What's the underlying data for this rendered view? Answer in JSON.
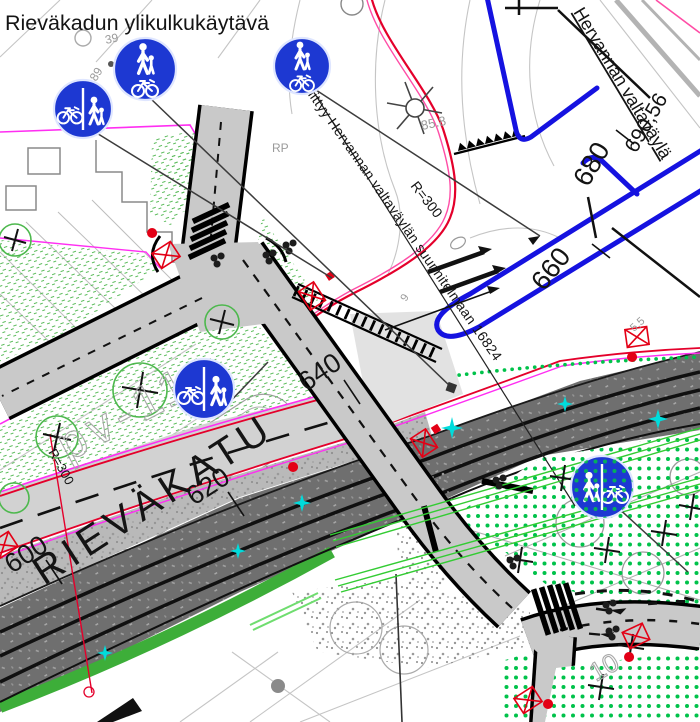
{
  "title": "Rieväkadun ylikulkukäytävä",
  "labels": {
    "connects_note": "Liittyy Hervannan valtaväylän suunnitelmaan 16824",
    "radius_a": "R=300",
    "radius_b": "R=300",
    "elevation": "85.8",
    "area_code": "pv-11",
    "ghost_39": "39",
    "ghost_89": "89",
    "ghost_rp": "RP",
    "ghost_9": "9",
    "ghost_55": "5,5",
    "ghost_10": "10"
  },
  "roads": {
    "rievakatu": "RIEVÄKATU",
    "hervanta": "Hervannan valtaväylä"
  },
  "stations": [
    "600",
    "620",
    "640",
    "660",
    "680",
    "690,56"
  ],
  "signs": [
    {
      "name": "combined-cycle-and-pedestrian-path-divided-sign"
    },
    {
      "name": "combined-cycle-and-pedestrian-path-sign"
    },
    {
      "name": "combined-cycle-and-pedestrian-path-sign"
    },
    {
      "name": "combined-cycle-and-pedestrian-path-divided-sign"
    },
    {
      "name": "combined-pedestrian-and-cycle-path-divided-sign"
    }
  ],
  "colors": {
    "sign_blue": "#1d38d2",
    "road_dark": "#6f6f6f",
    "road_light": "#d2d2d2",
    "path_gray": "#c9c9c9",
    "vegetation_dot_green": "#00c24a",
    "vegetation_hatch_green": "#5abb5a",
    "verge_green": "#3dae39",
    "boundary_magenta": "#ff2ef2",
    "edge_red": "#e4002b",
    "edge_pink": "#ff4da6",
    "utility_cyan": "#00dcdc",
    "barrier_blue": "#1512e0"
  }
}
